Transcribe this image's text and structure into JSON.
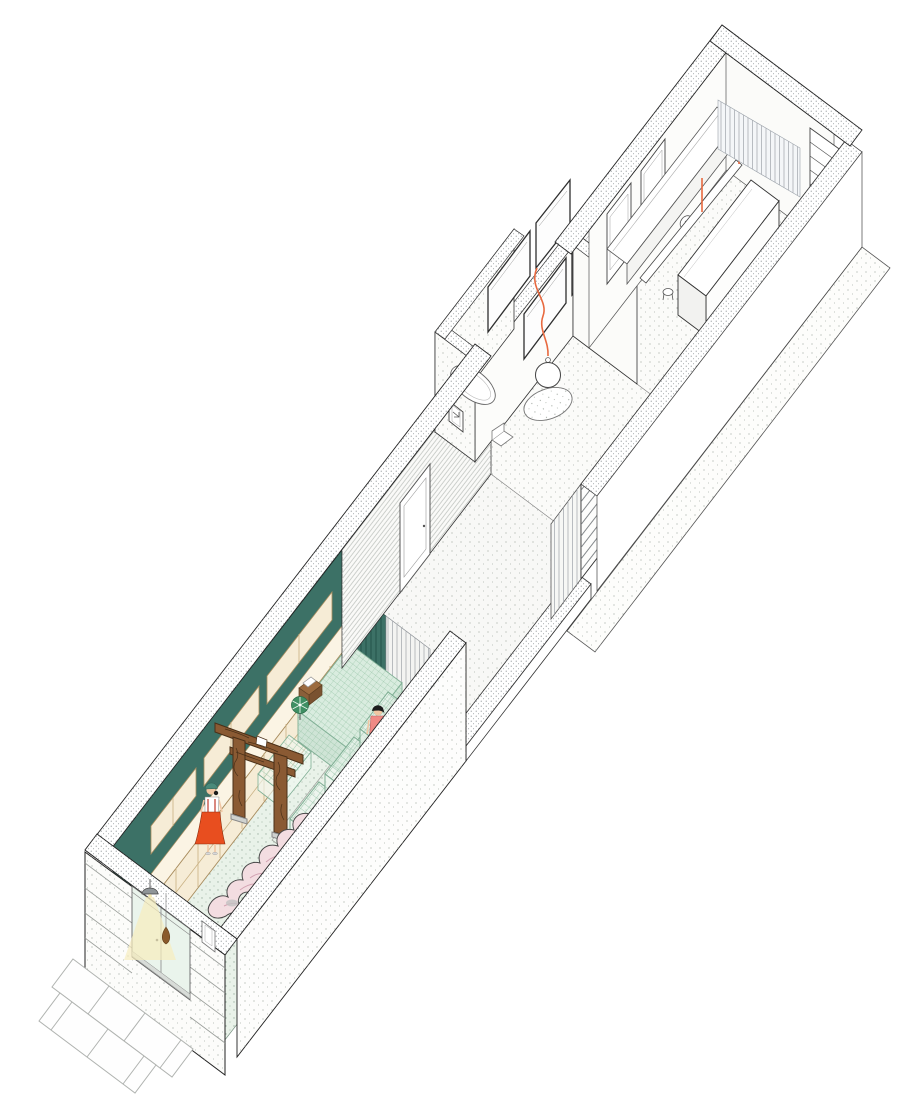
{
  "title": "Axonometric cutaway illustration of a long narrow building: retail space with torii gate and sculpture, corridor, bathroom annex, dining room and kitchen",
  "palette": {
    "teal": "#3c7166",
    "tealStripe": "#27554b",
    "mintFloor": "#e9f2e9",
    "cream": "#f6ecd6",
    "creamTop": "#fbf4e4",
    "counterMint": "#d9ecdf",
    "counterSide": "#cfe4d6",
    "meshLine": "#7fae94",
    "wood": "#8a5a33",
    "woodDark": "#4a3018",
    "sculpturePink": "#f3dde1",
    "sculptureLine": "#d3a2b2",
    "legRed": "#c0392b",
    "dressOrange": "#e84e1f",
    "capTeal": "#4a8a7a",
    "skin": "#f0c6a3",
    "coral": "#ef8a85",
    "skirtYellow": "#f2dc8e",
    "hairBlack": "#1c1c1c",
    "cordOrange": "#e8693f",
    "glow": "#f6edbe",
    "glassTint": "#eaf4ec",
    "pinwheelGreen": "#3f8f63",
    "registerBrown": "#9c6b3f",
    "dropBrown": "#8a5a2b"
  },
  "scene": {
    "rooms": [
      "retail-space",
      "corridor",
      "bathroom-annex",
      "dining-room",
      "kitchen",
      "side-walkway",
      "street-paving"
    ],
    "objects": [
      "stone-shelving",
      "checkout-counter",
      "cash-register",
      "green-pinwheel",
      "wire-mesh-display-tables",
      "torii-gate",
      "pink-sculpture-table",
      "entrance-glass-door",
      "entrance-pendant-lamp",
      "hanging-ornament",
      "sign-plaque",
      "bathtub",
      "glass-partition-grid",
      "sphere-pendant-lamp",
      "round-table",
      "chair",
      "kitchen-island",
      "wall-counter",
      "sink",
      "diagonal-plank",
      "stool",
      "curtain",
      "corner-shelf",
      "louver-screen",
      "slat-screen",
      "paving-slabs"
    ],
    "figures": [
      "shopper-in-orange-dress-with-teal-cap",
      "shopper-in-coral-top-and-yellow-skirt"
    ]
  }
}
